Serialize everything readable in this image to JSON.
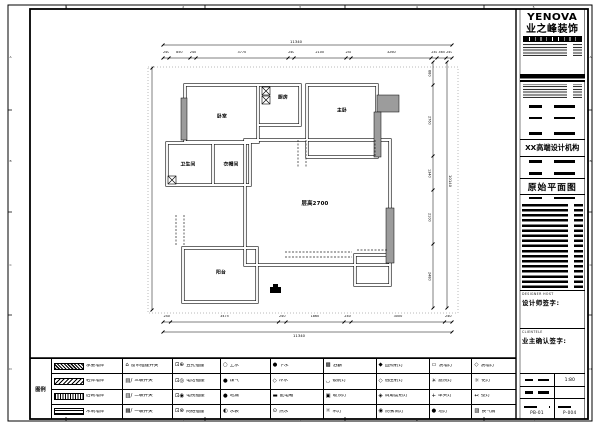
{
  "sheet": {
    "frame_marks_top": [
      "1",
      "2",
      "3",
      "4",
      "5"
    ],
    "frame_marks_bottom": [
      "1",
      "2",
      "3",
      "4",
      "5"
    ],
    "frame_marks_left": [
      "A",
      "B",
      "C",
      "D"
    ],
    "frame_marks_right": [
      "A",
      "B",
      "C",
      "D"
    ]
  },
  "titleblock": {
    "logo_main": "YENOVA",
    "logo_sub": "业之峰装饰",
    "org": "XX高端设计机构",
    "drawing_title": "原始平面图",
    "designer_en": "DESIGNER HOST",
    "designer_label": "设计师签字:",
    "client_en": "CLIENTELE",
    "client_label": "业主确认签字:",
    "scale": "1:80",
    "sheet_no": "PB-01",
    "page_no": "P-004"
  },
  "plan": {
    "rooms": [
      {
        "label": "卧室"
      },
      {
        "label": "厨房"
      },
      {
        "label": "主卧"
      },
      {
        "label": "卫生间"
      },
      {
        "label": "衣帽间"
      },
      {
        "label": "层高2700"
      },
      {
        "label": "阳台"
      }
    ],
    "dimensions": {
      "top_total": "11340",
      "top_segments": [
        240,
        850,
        240,
        3770,
        240,
        2100,
        240,
        3260,
        240,
        365,
        240
      ],
      "bottom_segments": [
        240,
        3475,
        240,
        1860,
        240,
        3000,
        240
      ],
      "bottom_total": "11340",
      "right_segments": [
        880,
        2760,
        1340,
        2100,
        2480
      ],
      "right_total": "10140"
    }
  },
  "legend": {
    "side_label": "图例",
    "columns": [
      {
        "flex": 8.4,
        "rows": [
          {
            "swatch": "hatch-a",
            "name": "load-bearing-wall",
            "label": "承重墙体"
          },
          {
            "swatch": "hatch-b",
            "name": "light-wall",
            "label": "轻体墙体"
          },
          {
            "swatch": "hatch-c",
            "name": "infill-wall",
            "label": "后砌墙体"
          },
          {
            "swatch": "hatch-d",
            "name": "wood-wall",
            "label": "木制墙体"
          }
        ]
      },
      {
        "flex": 5.8,
        "rows": [
          {
            "icon": "⌂",
            "name": "curtain-switch",
            "label": "窗帘插座开关"
          },
          {
            "icon": "▤/",
            "name": "triple-switch",
            "label": "三联开关"
          },
          {
            "icon": "▥/",
            "name": "double-switch",
            "label": "二联开关"
          },
          {
            "icon": "▦/",
            "name": "single-switch",
            "label": "一联开关"
          }
        ]
      },
      {
        "flex": 5.6,
        "rows": [
          {
            "icon": "⊡⊕",
            "name": "five-hole-socket",
            "label": "五孔插座"
          },
          {
            "icon": "⊡◎",
            "name": "phone-socket",
            "label": "电话插座"
          },
          {
            "icon": "⊡◉",
            "name": "tv-socket",
            "label": "电视插座"
          },
          {
            "icon": "⊡⊗",
            "name": "network-socket",
            "label": "网络插座"
          }
        ]
      },
      {
        "flex": 5.8,
        "rows": [
          {
            "icon": "○",
            "name": "water-supply",
            "label": "上水"
          },
          {
            "icon": "●",
            "name": "gas",
            "label": "煤气"
          },
          {
            "icon": "●",
            "name": "floor-drain",
            "label": "地漏"
          },
          {
            "icon": "◐",
            "name": "water-meter",
            "label": "水表"
          }
        ]
      },
      {
        "flex": 6.2,
        "rows": [
          {
            "icon": "●",
            "name": "drain",
            "label": "下水"
          },
          {
            "icon": "◇",
            "name": "cold-water",
            "label": "冷水"
          },
          {
            "icon": "▬",
            "name": "distribution-box",
            "label": "配电箱"
          },
          {
            "icon": "⊙",
            "name": "hot-water",
            "label": "热水"
          }
        ]
      },
      {
        "flex": 6.2,
        "rows": [
          {
            "icon": "▩",
            "name": "bath-heater",
            "label": "浴霸"
          },
          {
            "icon": "◡",
            "name": "mirror-light",
            "label": "镜前灯"
          },
          {
            "icon": "▣",
            "name": "ceiling-light",
            "label": "吸顶灯"
          },
          {
            "icon": "☼",
            "name": "pendant-light",
            "label": "吊灯"
          }
        ]
      },
      {
        "flex": 6.2,
        "rows": [
          {
            "icon": "◆",
            "name": "direct-spotlight",
            "label": "直照射灯"
          },
          {
            "icon": "◇",
            "name": "low-voltage-spotlight",
            "label": "低压射灯"
          },
          {
            "icon": "◈",
            "name": "adjustable-spotlight",
            "label": "调角度射灯"
          },
          {
            "icon": "◉",
            "name": "fog-proof-downlight",
            "label": "防雾筒灯"
          }
        ]
      },
      {
        "flex": 5.0,
        "rows": [
          {
            "icon": "▭",
            "name": "wall-washer-light",
            "label": "洗墙灯"
          },
          {
            "icon": "☀",
            "name": "garden-light",
            "label": "庭院灯"
          },
          {
            "icon": "+",
            "name": "single-head-light",
            "label": "单头灯"
          },
          {
            "icon": "●",
            "name": "floor-light",
            "label": "地灯"
          }
        ]
      },
      {
        "flex": 5.2,
        "rows": [
          {
            "icon": "◇",
            "name": "wash-wall-light",
            "label": "洗墙灯"
          },
          {
            "icon": "☼",
            "name": "chandelier",
            "label": "花灯"
          },
          {
            "icon": "↢",
            "name": "wall-lamp",
            "label": "壁灯"
          },
          {
            "icon": "▨",
            "name": "exhaust-fan",
            "label": "换气扇"
          }
        ]
      }
    ]
  }
}
